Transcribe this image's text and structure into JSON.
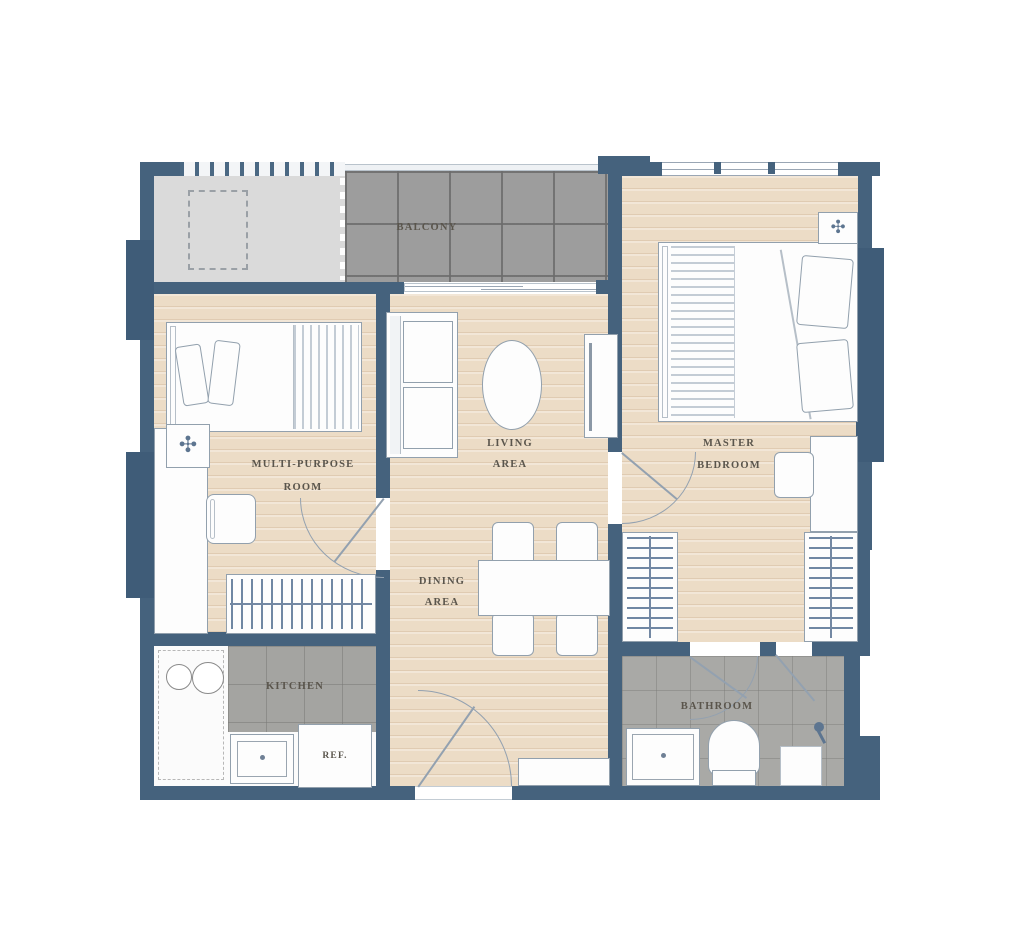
{
  "palette": {
    "wall": "#45627d",
    "window": "#3f5c78",
    "wood": "#ecdcc6",
    "balcony_floor": "#9d9d9d",
    "kitchen_floor": "#a4a4a1",
    "bathroom_floor": "#a9a9a6",
    "ledge_floor": "#dadada",
    "label_color": "#5a554c",
    "accent": "#5d7590",
    "furn_border": "#92a0ad"
  },
  "rooms": {
    "balcony": {
      "label": "BALCONY"
    },
    "multi_purpose": {
      "label_line1": "MULTI-PURPOSE",
      "label_line2": "ROOM"
    },
    "living": {
      "label_line1": "LIVING",
      "label_line2": "AREA"
    },
    "dining": {
      "label_line1": "DINING",
      "label_line2": "AREA"
    },
    "master": {
      "label_line1": "MASTER",
      "label_line2": "BEDROOM"
    },
    "kitchen": {
      "label": "KITCHEN"
    },
    "refrigerator": {
      "label": "REF."
    },
    "bathroom": {
      "label": "BATHROOM"
    }
  },
  "icons": {
    "ac_fan": "✣"
  }
}
